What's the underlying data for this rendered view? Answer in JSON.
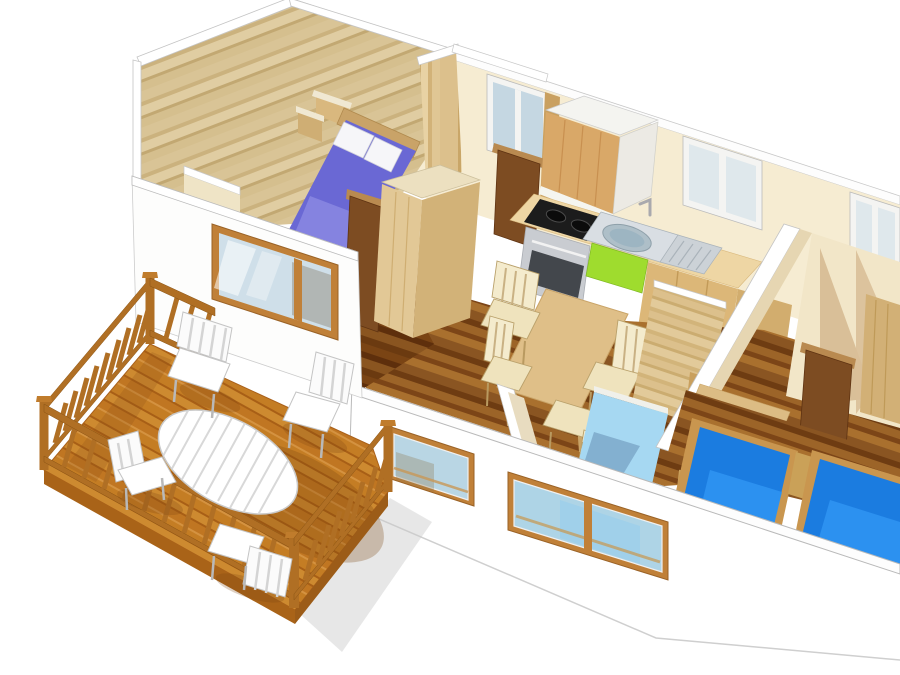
{
  "meta": {
    "title": "3D isometric cutaway floor plan of a mobile home with wooden terrace",
    "canvas_width": 900,
    "canvas_height": 675,
    "render_style": "sketchup-style dollhouse cutaway, no text rendered in image"
  },
  "palette": {
    "background": "#ffffff",
    "wall_cut_white": "#fdfdfd",
    "wall_cream": "#f6ecd2",
    "wall_cream_shadow": "#d9bf98",
    "wood_gable": "#d8c296",
    "wood_wardrobe": "#e2c896",
    "wood_wardrobe_side": "#d2b278",
    "wood_cabinet_front": "#d9a868",
    "wood_counter": "#eed6a4",
    "wood_base_cabinet": "#dcb778",
    "wood_table": "#dfbf88",
    "wood_headboard": "#c9a368",
    "door_brown": "#7d4c22",
    "door_frame": "#b98a50",
    "bed_purple": "#6a68d4",
    "bed_purple_light": "#8a88e2",
    "pillow": "#f6f6f9",
    "bed_light_blue": "#a6d8f2",
    "bed_light_blue_side": "#7fb9d8",
    "bed_blue": "#1b7ce0",
    "bed_blue_light": "#2f93f2",
    "bed_blue_dark": "#0f5fb8",
    "bed_frame_wood": "#c9964f",
    "green_accent": "#9fdc2e",
    "steel": "#c9ccd1",
    "oven_window": "#43474c",
    "cooktop": "#1c1c1c",
    "sink_steel": "#d9dee3",
    "sink_basin": "#aebfc8",
    "glass_cool": "#c5d7e2",
    "glass_blue": "#aed4e6",
    "glass_sky": "#cfdfe9",
    "window_wood": "#c08038",
    "deck_rail": "#b06f24",
    "deck_shadow": "#7a4410",
    "outdoor_white": "#ffffff",
    "stripe_orange": "#e07828"
  },
  "scene": {
    "terrace": {
      "name": "wooden deck terrace",
      "features": [
        "orange wood plank floor laid diagonally",
        "balustrade railing on three sides with corner posts",
        "white oval slatted garden table",
        "four white slatted garden chairs",
        "cast shadows on deck and ground"
      ]
    },
    "rooms": [
      {
        "name": "master bedroom",
        "position": "left end",
        "features": [
          "double bed with purple-blue duvet",
          "two white pillows",
          "wood headboard with stepped shelves",
          "wood plank gable wall",
          "low white partition",
          "wood framed window to terrace"
        ]
      },
      {
        "name": "bathroom",
        "position": "back wall, center-left",
        "features": [
          "white framed window",
          "dark brown door",
          "wood panel walls"
        ]
      },
      {
        "name": "kitchen",
        "position": "along back wall",
        "features": [
          "black two-burner cooktop",
          "stainless oven",
          "oval stainless sink with faucet",
          "ribbed drainboard",
          "lime green cabinet front",
          "light wood base cabinets",
          "overhead cabinet box",
          "window above counter"
        ]
      },
      {
        "name": "dining area",
        "position": "center",
        "features": [
          "light wood dining table",
          "four light wood chairs with cream seats",
          "dark wood plank floor"
        ]
      },
      {
        "name": "second bedroom",
        "position": "center-right",
        "features": [
          "single bed with light blue cover",
          "wood wardrobe",
          "striped wood bed post"
        ]
      },
      {
        "name": "third bedroom",
        "position": "right end",
        "features": [
          "two single beds with bright blue covers",
          "wood bed frames",
          "dark brown door",
          "cream walls with cast shadow",
          "wood end panel"
        ]
      }
    ],
    "exterior": {
      "front_wall": "white with two wood-framed windows",
      "back_wall": "cream with three white-framed windows",
      "roofline": "slanted gable trim over master bedroom"
    }
  }
}
